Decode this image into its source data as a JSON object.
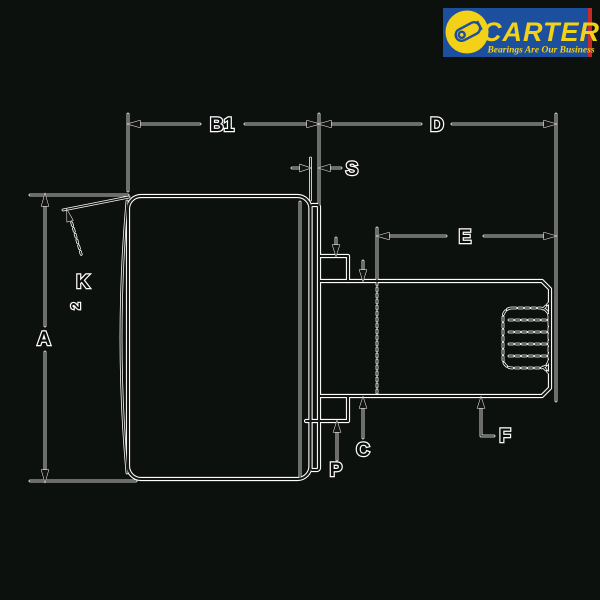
{
  "logo": {
    "brand": "CARTER",
    "tagline": "Bearings Are Our Business",
    "bg_color": "#1d4f9f",
    "text_color": "#f2d117",
    "circle_color": "#f2d117",
    "stripe_color": "#c62b29",
    "icon": "cam-follower-icon"
  },
  "drawing": {
    "type": "dimensioned engineering drawing of stud-type crowned cam follower bearing",
    "background": "#0d110d",
    "line_color": "#161616",
    "halo_color": "#ffffff",
    "labels": {
      "A": "A",
      "B1": "B1",
      "C": "C",
      "D": "D",
      "E": "E",
      "F": "F",
      "K": "K",
      "K_sub": "2",
      "P": "P",
      "S": "S"
    }
  }
}
